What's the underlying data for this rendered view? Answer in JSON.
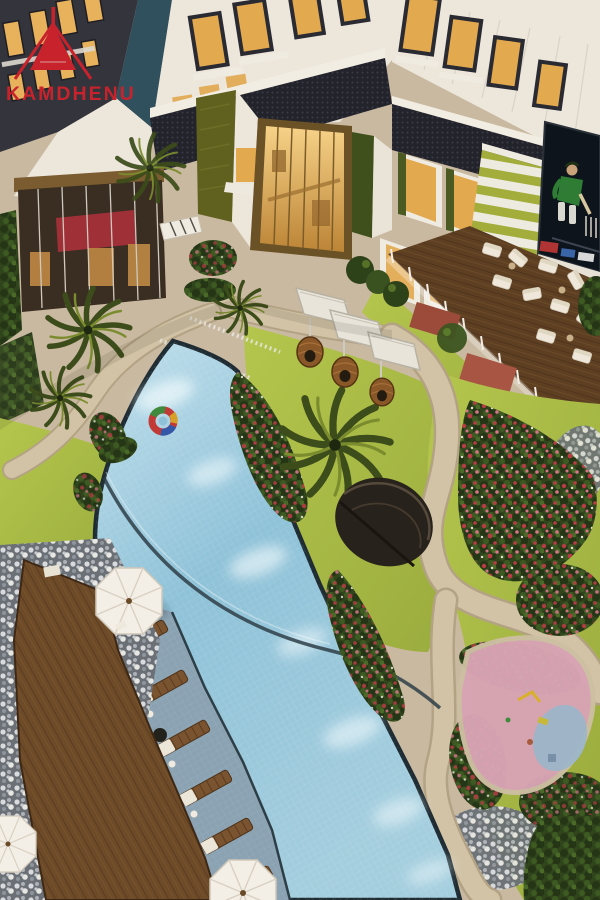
{
  "logo": {
    "brand": "KAMDHENU"
  },
  "palette": {
    "brand": "#c8232c",
    "courtyard": "#c9b9a0",
    "pool-light": "#c2e0ec",
    "pool-mid": "#8fc2d8",
    "pool-low": "#a4cede",
    "lawn": "#9aab3e",
    "lawn-bright": "#b4c64c",
    "path": "#d2c3a6",
    "path-edge": "#b3a284",
    "deck": "#6e4b28",
    "deck-line": "#53361c",
    "facade": "#ece6db",
    "facade-bright": "#f2ede3",
    "band-dark": "#23232b",
    "window-warm": "#e2a94f",
    "teal-wall": "#31505e",
    "olive-panel": "#61611f",
    "stripe-green": "#a3ad3c",
    "bush": "#31451c",
    "flower-red": "#b93c45",
    "flower-pink": "#d4758a",
    "pebble": "#6a7076",
    "shelf": "#8aa2b2",
    "screen-bg": "#0e141c",
    "cricket-green": "#2f7c35",
    "umbrella": "#f4efe6",
    "play-pink": "#d8a4b4",
    "play-blue": "#9cb6c8",
    "canopy": "#e8e4da",
    "pod": "#8a5828",
    "awning-red": "#a03038"
  }
}
